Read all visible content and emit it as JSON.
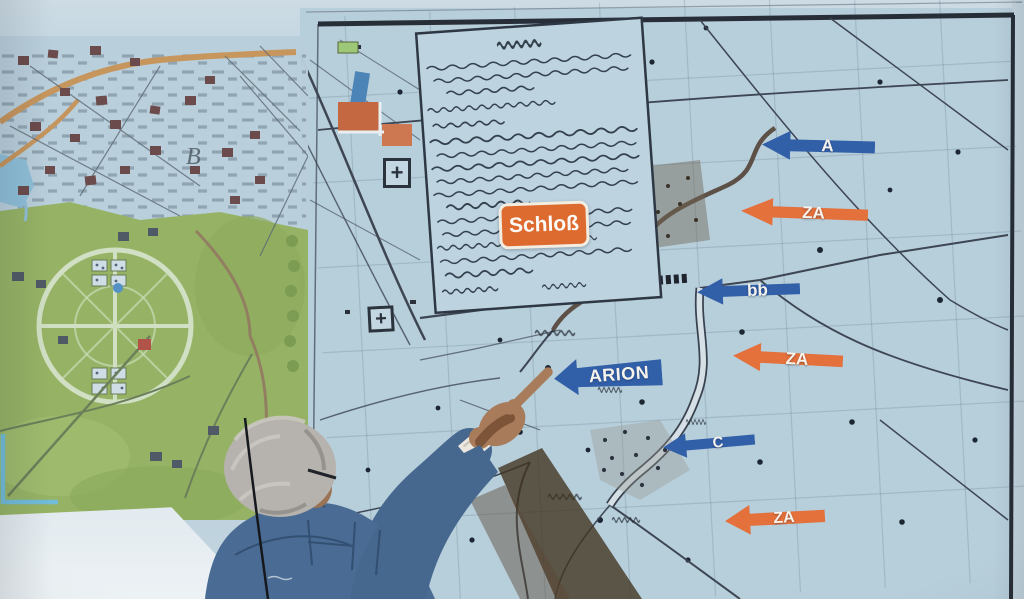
{
  "scene_title": "Presenter pointing at projected historical maps",
  "schloss": {
    "label": "Schloß",
    "bg": "#dd6a2e"
  },
  "arrows": [
    {
      "id": "A",
      "label": "A",
      "color": "#315fa8",
      "direction": "left"
    },
    {
      "id": "ZA-1",
      "label": "ZA",
      "color": "#e4703b",
      "direction": "left"
    },
    {
      "id": "bb",
      "label": "bb",
      "color": "#315fa8",
      "direction": "left"
    },
    {
      "id": "ZA-2",
      "label": "ZA",
      "color": "#e4703b",
      "direction": "left"
    },
    {
      "id": "ARION",
      "label": "ARION",
      "color": "#315fa8",
      "direction": "left"
    },
    {
      "id": "C",
      "label": "C",
      "color": "#315fa8",
      "direction": "left"
    },
    {
      "id": "ZA-3",
      "label": "ZA",
      "color": "#e4703b",
      "direction": "left"
    }
  ],
  "city_map": {
    "annotation_letter": "B"
  },
  "icons": {
    "landmark_cross": "+"
  },
  "colors": {
    "screen": "#bdd2de",
    "map_paper": "#b7cedb",
    "arrow_blue": "#315fa8",
    "arrow_orange": "#e4703b",
    "schloss_bg": "#dd6a2e",
    "park_green": "#8fae4e",
    "road_orange": "#c98a44",
    "denim": "#4a6c94"
  }
}
